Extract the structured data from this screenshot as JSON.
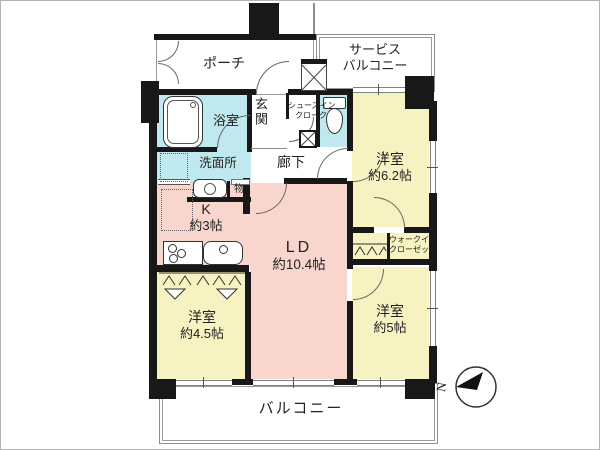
{
  "title": "マンション間取り図",
  "colors": {
    "wall": "#181818",
    "water_rooms": "#bfe9ee",
    "bedrooms": "#f6f2c2",
    "living_kitchen": "#f8d6ce",
    "outline_gray": "#8c8c8c"
  },
  "rooms": {
    "porch": {
      "label": "ポーチ"
    },
    "service_balcony": {
      "line1": "サービス",
      "line2": "バルコニー"
    },
    "bathroom": {
      "label": "浴室"
    },
    "entrance": {
      "label": "玄関"
    },
    "shoe_closet": {
      "line1": "シューズイン",
      "line2": "クローク"
    },
    "hallway": {
      "label": "廊下"
    },
    "washroom": {
      "label": "洗面所"
    },
    "storage": {
      "label": "物"
    },
    "kitchen": {
      "label": "K",
      "size": "約3帖"
    },
    "living_dining": {
      "label": "LD",
      "size": "約10.4帖"
    },
    "bedroom_62": {
      "label": "洋室",
      "size": "約6.2帖"
    },
    "walk_in_closet": {
      "line1": "ウォークイン",
      "line2": "クローゼット"
    },
    "bedroom_5": {
      "label": "洋室",
      "size": "約5帖"
    },
    "bedroom_45": {
      "label": "洋室",
      "size": "約4.5帖"
    },
    "balcony": {
      "label": "バルコニー"
    }
  },
  "compass": {
    "north_label": "N"
  }
}
